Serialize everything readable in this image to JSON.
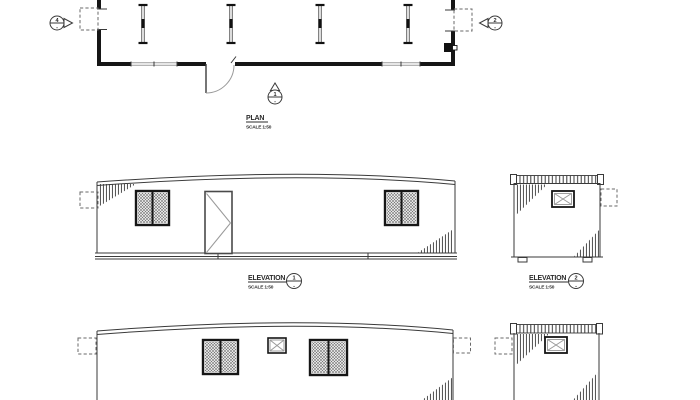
{
  "plan": {
    "title": "PLAN",
    "scale": "SCALE 1:50",
    "marker_left_number": "4",
    "marker_right_number": "2",
    "marker_door_number": "1",
    "marker_sheet_ref": "-"
  },
  "elevation_front": {
    "title": "ELEVATION",
    "scale": "SCALE 1:50",
    "number": "1"
  },
  "elevation_side": {
    "title": "ELEVATION",
    "scale": "SCALE 1:50",
    "number": "2"
  },
  "colors": {
    "wall": "#161616",
    "line": "#3a3a3a",
    "light": "#9a9a9a",
    "text": "#2b2b2b",
    "bg": "#ffffff"
  }
}
